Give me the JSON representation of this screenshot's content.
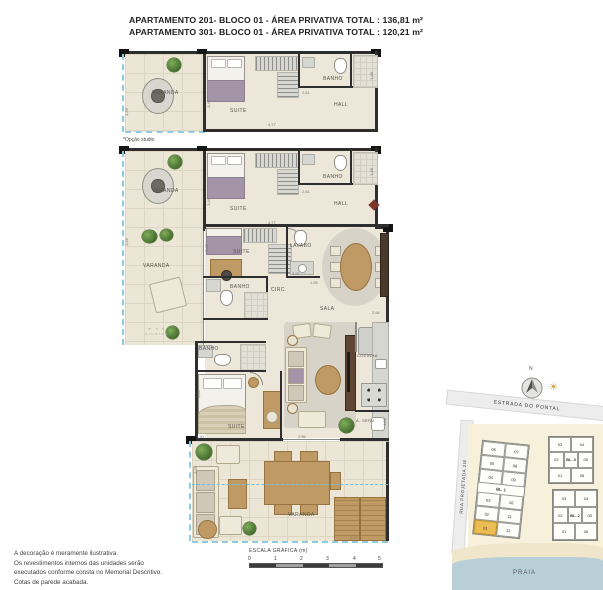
{
  "header": {
    "line1": "APARTAMENTO 201- BLOCO 01 - ÁREA PRIVATIVA TOTAL : 136,81 m²",
    "line2": "APARTAMENTO 301- BLOCO 01 - ÁREA PRIVATIVA TOTAL : 120,21 m²"
  },
  "rooms": {
    "varanda": "VARANDA",
    "suite": "SUITE",
    "banho": "BANHO",
    "hall": "HALL",
    "lavabo": "LAVABO",
    "circ": "CIRC.",
    "sala": "SALA",
    "cozinha": "COZINHA",
    "aserv": "Á. SERV."
  },
  "studio_note": "*Opção studio",
  "dims": [
    "1,56",
    "3,40",
    "4,77",
    "2,61",
    "1,88",
    "1,56",
    "3,40",
    "4,77",
    "2,61",
    "1,88",
    "2,47",
    "3,57",
    "1,55",
    "2,89",
    "5,65",
    "4,97",
    "1,30",
    "2,86",
    "2,66",
    "1,85"
  ],
  "watermark": {
    "line1": "m b b",
    "line2": "studios"
  },
  "scale_bar": {
    "title": "ESCALA GRÁFICA (m)",
    "ticks": [
      "0",
      "1",
      "2",
      "3",
      "4",
      "5"
    ]
  },
  "footer": {
    "line1": "A decoração é meramente ilustrativa.",
    "line2": "Os revestimentos internos das unidades serão",
    "line3": "executados conforme consta no Memorial Descritivo.",
    "line4": "Cotas de parede acabada."
  },
  "site_map": {
    "north_label": "N",
    "street_top": "ESTRADA DO PONTAL",
    "street_left": "RUA PROJETADA 2W",
    "beach_label": "PRAIA",
    "bl1": {
      "label": "BL. 1",
      "rows": [
        [
          "06",
          "07"
        ],
        [
          "05",
          "08"
        ],
        [
          "04",
          "09"
        ],
        [
          "03",
          "10"
        ],
        [
          "02",
          "11"
        ],
        [
          "01",
          "12"
        ]
      ],
      "highlighted_unit": "01"
    },
    "bl3": {
      "label": "BL. 3",
      "rows": [
        [
          "03",
          "04"
        ],
        [
          "02",
          "05"
        ],
        [
          "01",
          "06"
        ]
      ]
    },
    "bl2": {
      "label": "BL. 2",
      "rows": [
        [
          "03",
          "04"
        ],
        [
          "02",
          "05"
        ],
        [
          "01",
          "06"
        ]
      ]
    }
  },
  "colors": {
    "wall": "#2E2E2E",
    "floor": "#ECE7D9",
    "highlight_unit": "#ECBD52",
    "water": "#B9CFD7",
    "rail_dash": "#8FCBE0",
    "entrance_marker": "#7D352C",
    "bed_accent": "#A394A8",
    "wood": "#BD9560"
  }
}
